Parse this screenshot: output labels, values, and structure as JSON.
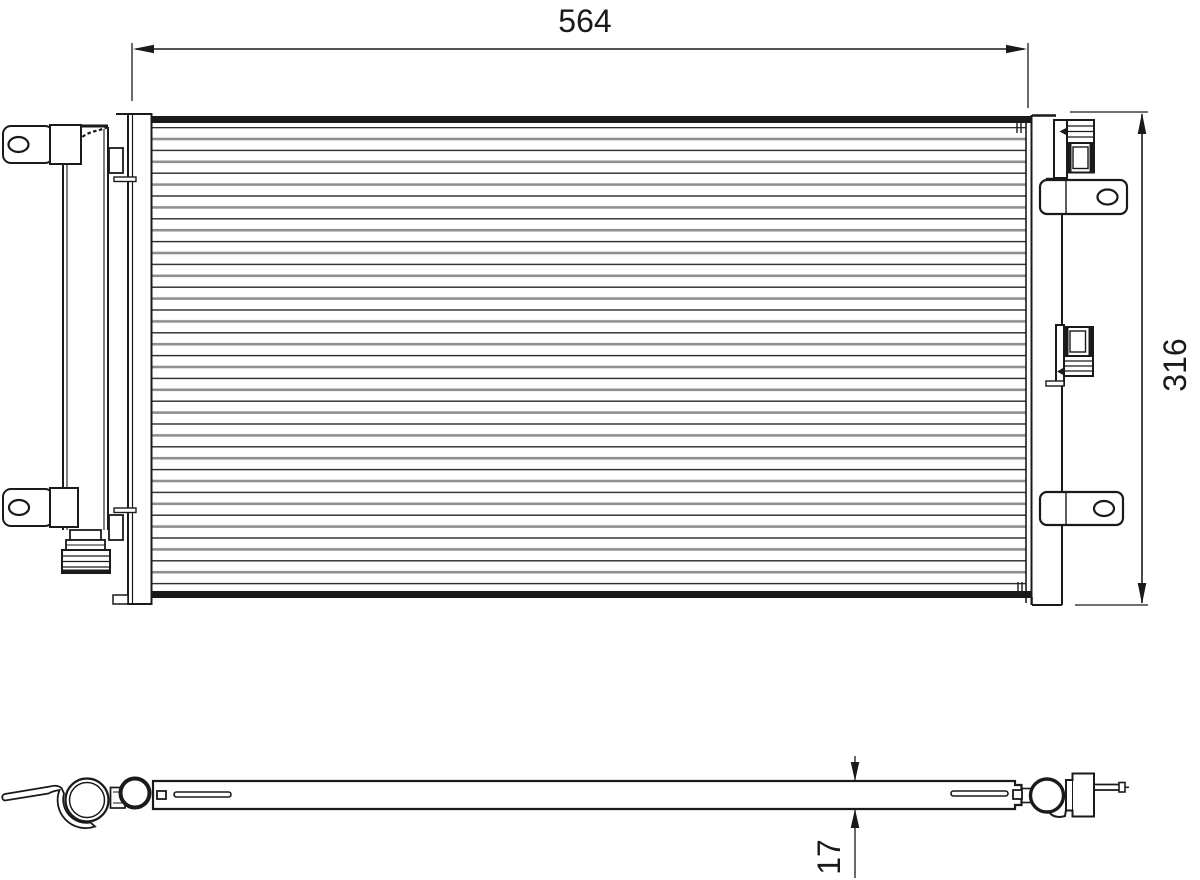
{
  "page": {
    "background": "#ffffff",
    "line_color": "#1a1a1a",
    "fin_line_gray": "#8f8f8f",
    "fin_line_dark": "#2b2b2b"
  },
  "dimensions": {
    "width_label": "564",
    "height_label": "316",
    "thickness_label": "17"
  }
}
